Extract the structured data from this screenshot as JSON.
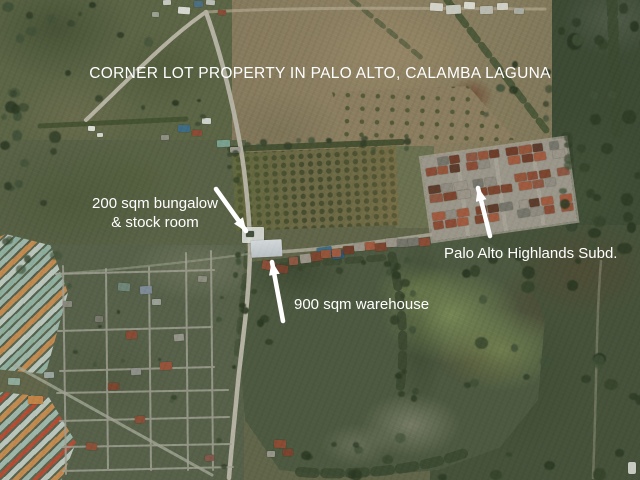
{
  "image": {
    "kind": "annotated aerial satellite photo",
    "width_px": 640,
    "height_px": 480
  },
  "annotations": {
    "text_color": "#ffffff",
    "title": "CORNER LOT PROPERTY IN PALO ALTO, CALAMBA LAGUNA",
    "bungalow_line1": "200 sqm bungalow",
    "bungalow_line2": "& stock room",
    "warehouse_label": "900 sqm warehouse",
    "subdivision_label": "Palo Alto Highlands Subd.",
    "arrows": [
      {
        "label": "bungalow",
        "from": [
          216,
          189
        ],
        "to": [
          246,
          231
        ]
      },
      {
        "label": "warehouse",
        "from": [
          283,
          321
        ],
        "to": [
          272,
          262
        ]
      },
      {
        "label": "subdivision",
        "from": [
          490,
          236
        ],
        "to": [
          478,
          188
        ]
      }
    ]
  },
  "palette": {
    "field_olive": "#5d6547",
    "field_dark_green": "#3e4b33",
    "field_tan": "#8c7e60",
    "property_field_green": "#4e5940",
    "road_gray": "#b3b0a1",
    "roof_rust": "#8a4c36",
    "roof_teal": "#9ab5a6",
    "roof_orange": "#c08a50",
    "roof_blue": "#3f6c85",
    "warehouse_roof": "#ccd2d4",
    "annotation_white": "#ffffff"
  }
}
